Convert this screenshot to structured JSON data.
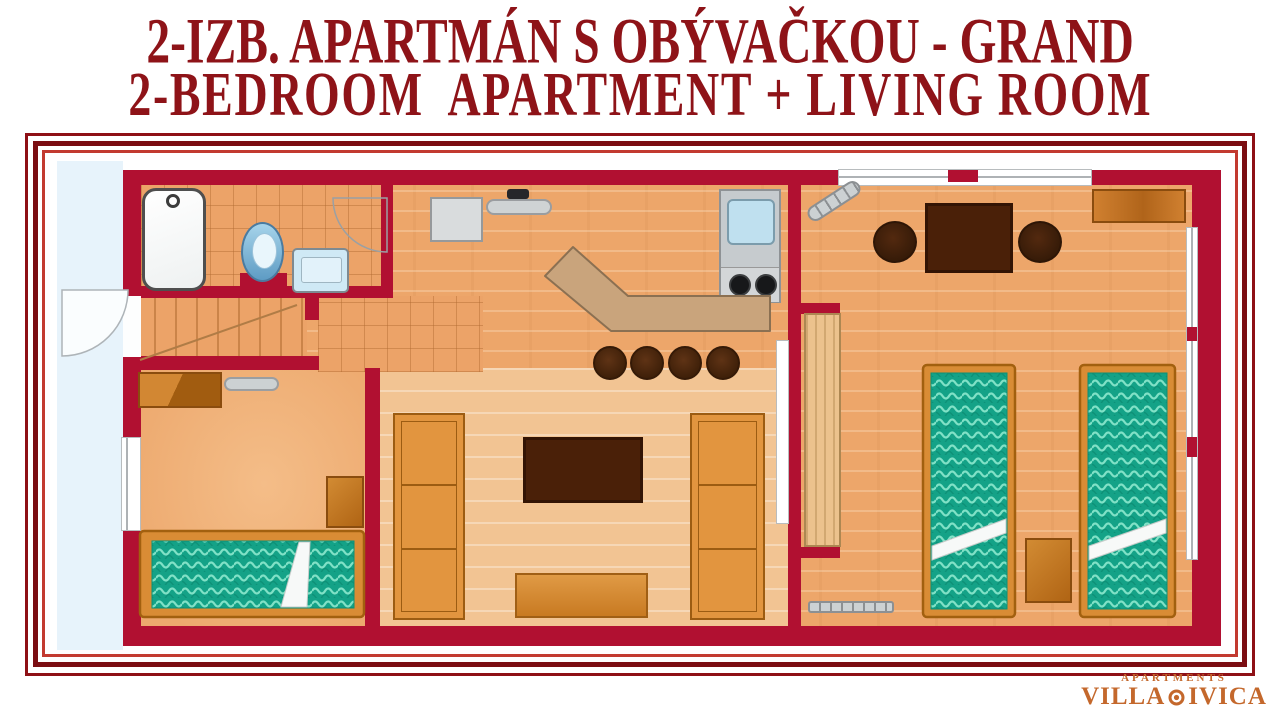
{
  "title": {
    "line1": "2-IZB. APARTMÁN S OBÝVAČKOU - GRAND",
    "line2": "2-BEDROOM  APARTMENT + LIVING ROOM"
  },
  "logo": {
    "apartments": "APARTMENTS",
    "villa": "VILLA",
    "ivica": "IVICA"
  },
  "colors": {
    "title_red": "#8e1318",
    "wall_crimson": "#b11031",
    "frame_outer": "#8e1016",
    "frame_middle": "#7b0d12",
    "frame_inner": "#c23a30",
    "floor_wood": "#eda66a",
    "floor_light": "#f2c493",
    "tile_line": "#c08148",
    "outside_blue": "#e7f3fb",
    "mattress_teal": "#14a287",
    "mattress_wave": "#8ce8cd",
    "bed_frame_wood": "#d98c35",
    "dark_furniture": "#4a2008",
    "cabinet_wood": "#d8862c",
    "counter_tan": "#c9a47c",
    "appliance_gray": "#c9ced1",
    "fixture_blue": "#bfe0ef",
    "logo_orange": "#c4682c"
  },
  "plan": {
    "rooms": [
      {
        "name": "bathroom",
        "fixtures": [
          "bathtub-icon",
          "toilet-icon",
          "washbasin-icon",
          "door-swing-icon"
        ]
      },
      {
        "name": "entrance-hall",
        "fixtures": [
          "entrance-door-swing-icon",
          "staircase-icon"
        ]
      },
      {
        "name": "kitchen",
        "fixtures": [
          "fridge-icon",
          "cooker-hood-icon",
          "kitchen-sink-icon",
          "stove-icon",
          "breakfast-bar-icon",
          "bar-stool-icon",
          "bar-stool-icon",
          "bar-stool-icon",
          "bar-stool-icon"
        ]
      },
      {
        "name": "living-room",
        "fixtures": [
          "wardrobe-icon",
          "wardrobe-icon",
          "tv-table-icon",
          "coffee-table-icon",
          "door-leaf-icon"
        ]
      },
      {
        "name": "bedroom-left",
        "fixtures": [
          "double-bed-icon",
          "dresser-icon",
          "wall-shelf-icon",
          "nightstand-icon",
          "window-icon"
        ]
      },
      {
        "name": "bedroom-right",
        "fixtures": [
          "single-bed-icon",
          "single-bed-icon",
          "nightstand-icon",
          "dining-table-icon",
          "chair-icon",
          "chair-icon",
          "sideboard-icon",
          "tall-cabinet-icon",
          "radiator-icon",
          "radiator-icon",
          "window-icon",
          "window-icon"
        ]
      }
    ]
  }
}
